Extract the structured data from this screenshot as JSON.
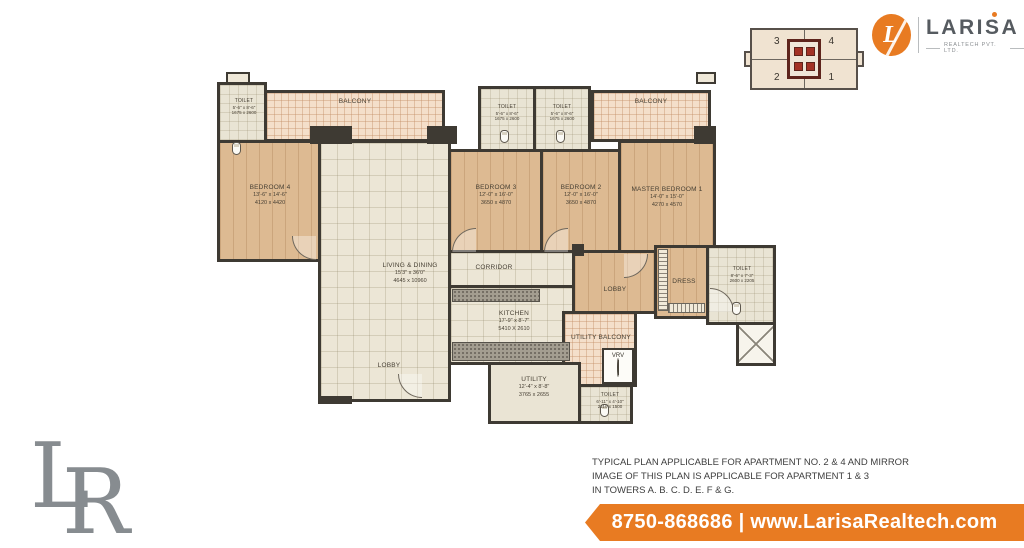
{
  "brand": {
    "logo_text": "LARISA",
    "logo_sub": "REALTECH PVT. LTD.",
    "monogram": "L"
  },
  "keyplan": {
    "tl": "3",
    "tr": "4",
    "bl": "2",
    "br": "1"
  },
  "plan": {
    "rooms": {
      "toilet_tl": {
        "name": "TOILET",
        "ft": "5'-6\" x 8'-6\"",
        "mm": "1675 x 2600"
      },
      "balcony_left": {
        "name": "BALCONY"
      },
      "toilet_m1": {
        "name": "TOILET",
        "ft": "5'-6\" x 8'-6\"",
        "mm": "1675 x 2600"
      },
      "toilet_m2": {
        "name": "TOILET",
        "ft": "5'-6\" x 8'-6\"",
        "mm": "1675 x 2600"
      },
      "balcony_right": {
        "name": "BALCONY"
      },
      "bedroom4": {
        "name": "BEDROOM 4",
        "ft": "13'-6\" x 14'-6\"",
        "mm": "4120 x 4420"
      },
      "bedroom3": {
        "name": "BEDROOM 3",
        "ft": "12'-0\" x 16'-0\"",
        "mm": "3650 x 4870"
      },
      "bedroom2": {
        "name": "BEDROOM 2",
        "ft": "12'-0\" x 16'-0\"",
        "mm": "3650 x 4870"
      },
      "master": {
        "name": "MASTER BEDROOM 1",
        "ft": "14'-0\" x 15'-0\"",
        "mm": "4270 x 4570"
      },
      "living": {
        "name": "LIVING & DINING",
        "ft": "15'3\" x 36'0\"",
        "mm": "4645 x 10960"
      },
      "corridor": {
        "name": "CORRIDOR"
      },
      "lobby_r": {
        "name": "LOBBY"
      },
      "dress": {
        "name": "DRESS"
      },
      "toilet_r": {
        "name": "TOILET",
        "ft": "8'-6\" x 7'-3\"",
        "mm": "2600 x 2205"
      },
      "kitchen": {
        "name": "KITCHEN",
        "ft": "17'-9\" x 8'-7\"",
        "mm": "5410 X 2610"
      },
      "utility_balcony": {
        "name": "UTILITY BALCONY"
      },
      "vrv": {
        "name": "VRV"
      },
      "utility": {
        "name": "UTILITY",
        "ft": "12'-4\" x 8'-8\"",
        "mm": "3765 x 2655"
      },
      "toilet_b": {
        "name": "TOILET",
        "ft": "6'-11\" x 4'-10\"",
        "mm": "2110 x 1500"
      },
      "lobby_b": {
        "name": "LOBBY"
      }
    }
  },
  "watermark": {
    "l": "L",
    "r": "R"
  },
  "disclaimer": {
    "line1": "TYPICAL PLAN APPLICABLE FOR APARTMENT NO. 2 & 4 AND MIRROR",
    "line2": "IMAGE OF THIS PLAN IS APPLICABLE FOR APARTMENT 1 & 3",
    "line3": "IN TOWERS A. B. C. D. E. F & G."
  },
  "banner": {
    "text": "8750-868686 | www.LarisaRealtech.com"
  },
  "colors": {
    "accent": "#e87b22",
    "wall": "#3e3a33",
    "wood": "#ddba92",
    "tile": "#ece6d6",
    "balcony": "#f4dfca"
  }
}
